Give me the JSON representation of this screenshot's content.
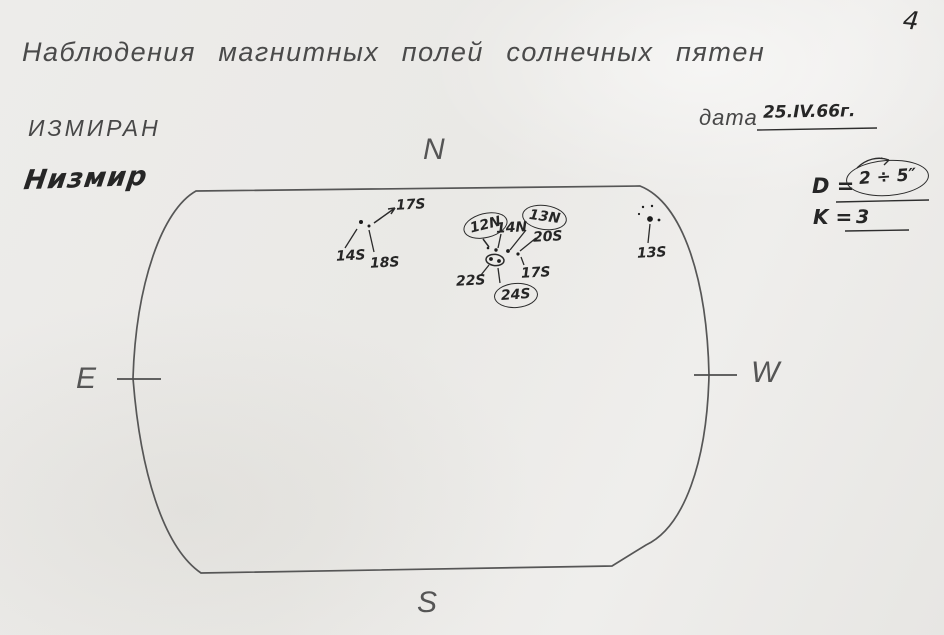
{
  "page": {
    "number": "4",
    "title": "Наблюдения магнитных полей солнечных пятен"
  },
  "header": {
    "observatory_typed": "ИЗМИРАН",
    "observatory_handwritten": "Низмир",
    "date_label": "дата",
    "date_value": "25.IV.66г.",
    "d_label": "D =",
    "d_value": "2 ÷ 5″",
    "k_label": "K =",
    "k_value": "3"
  },
  "compass": {
    "north": "N",
    "south": "S",
    "east": "E",
    "west": "W"
  },
  "spots": [
    {
      "label": "17S",
      "group": "left"
    },
    {
      "label": "14S",
      "group": "left"
    },
    {
      "label": "18S",
      "group": "left"
    },
    {
      "label": "12N",
      "group": "center",
      "circled": true
    },
    {
      "label": "14N",
      "group": "center"
    },
    {
      "label": "13N",
      "group": "center",
      "circled": true
    },
    {
      "label": "20S",
      "group": "center"
    },
    {
      "label": "22S",
      "group": "center"
    },
    {
      "label": "17S",
      "group": "center"
    },
    {
      "label": "24S",
      "group": "center",
      "circled": true
    },
    {
      "label": "13S",
      "group": "right"
    }
  ],
  "ink": {
    "typed_color": "#4a4a4a",
    "hand_color": "#262626",
    "outline_color": "#555555"
  }
}
